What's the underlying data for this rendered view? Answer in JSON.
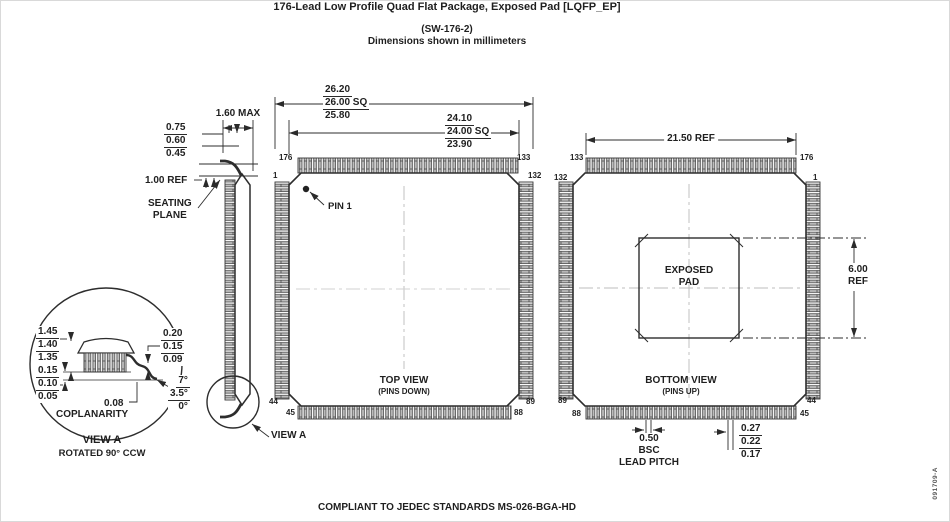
{
  "title": {
    "line1": "176-Lead Low Profile Quad Flat Package, Exposed Pad [LQFP_EP]",
    "line2": "(SW-176-2)",
    "line3": "Dimensions shown in millimeters"
  },
  "side_view": {
    "foot_length": [
      "0.75",
      "0.60",
      "0.45"
    ],
    "overall_height": "1.60 MAX",
    "standoff": "1.00 REF",
    "seating_plane": "SEATING\nPLANE",
    "view_a_callout": "VIEW A"
  },
  "top_view": {
    "label": "TOP VIEW",
    "sublabel": "(PINS DOWN)",
    "pin1_label": "PIN 1",
    "overall_span": [
      "26.20",
      "26.00 SQ",
      "25.80"
    ],
    "body_span": [
      "24.10",
      "24.00 SQ",
      "23.90"
    ],
    "pins": {
      "top_left": "176",
      "top_right": "133",
      "left_top": "1",
      "right_top": "132",
      "left_bottom": "44",
      "right_bottom": "89",
      "bottom_left": "45",
      "bottom_right": "88"
    }
  },
  "bottom_view": {
    "label": "BOTTOM VIEW",
    "sublabel": "(PINS UP)",
    "exposed_pad": "EXPOSED\nPAD",
    "lead_span": "21.50 REF",
    "pad_size": "6.00\nREF",
    "lead_pitch": [
      "0.50",
      "BSC",
      "LEAD PITCH"
    ],
    "lead_width": [
      "0.27",
      "0.22",
      "0.17"
    ],
    "pins": {
      "top_left": "133",
      "top_right": "176",
      "left_top": "132",
      "right_top": "1",
      "left_bottom": "89",
      "right_bottom": "44",
      "bottom_left": "88",
      "bottom_right": "45"
    }
  },
  "view_a": {
    "body_thickness": [
      "1.45",
      "1.40",
      "1.35"
    ],
    "standoff_height": [
      "0.15",
      "0.10",
      "0.05"
    ],
    "lead_thickness": [
      "0.20",
      "0.15",
      "0.09"
    ],
    "foot_angle": [
      "7°",
      "3.5°",
      "0°"
    ],
    "coplanarity_value": "0.08",
    "coplanarity_label": "COPLANARITY",
    "title": "VIEW A",
    "subtitle": "ROTATED 90° CCW"
  },
  "footer": {
    "compliance": "COMPLIANT TO JEDEC STANDARDS MS-026-BGA-HD",
    "doc_number": "091709-A"
  }
}
